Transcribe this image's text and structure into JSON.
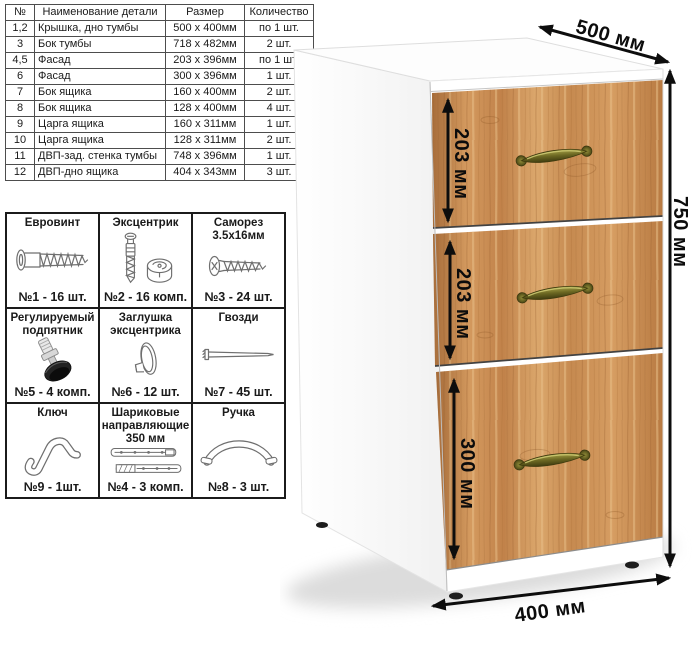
{
  "parts_table": {
    "headers": {
      "num": "№",
      "name": "Наименование детали",
      "size": "Размер",
      "qty": "Количество"
    },
    "rows": [
      {
        "num": "1,2",
        "name": "Крышка, дно тумбы",
        "size": "500 x 400мм",
        "qty": "по 1 шт."
      },
      {
        "num": "3",
        "name": "Бок тумбы",
        "size": "718 x 482мм",
        "qty": "2 шт."
      },
      {
        "num": "4,5",
        "name": "Фасад",
        "size": "203 x 396мм",
        "qty": "по 1 шт."
      },
      {
        "num": "6",
        "name": "Фасад",
        "size": "300 x 396мм",
        "qty": "1 шт."
      },
      {
        "num": "7",
        "name": "Бок ящика",
        "size": "160 x 400мм",
        "qty": "2 шт."
      },
      {
        "num": "8",
        "name": "Бок ящика",
        "size": "128 x 400мм",
        "qty": "4 шт."
      },
      {
        "num": "9",
        "name": "Царга ящика",
        "size": "160 x 311мм",
        "qty": "1 шт."
      },
      {
        "num": "10",
        "name": "Царга ящика",
        "size": "128 x 311мм",
        "qty": "2 шт."
      },
      {
        "num": "11",
        "name": "ДВП-зад. стенка тумбы",
        "size": "748 x 396мм",
        "qty": "1 шт."
      },
      {
        "num": "12",
        "name": "ДВП-дно ящика",
        "size": "404 x 343мм",
        "qty": "3 шт."
      }
    ]
  },
  "hardware": {
    "items": [
      {
        "title": "Евровинт",
        "qty": "№1 - 16 шт.",
        "icon": "euro-screw-icon"
      },
      {
        "title": "Эксцентрик",
        "qty": "№2 - 16 комп.",
        "icon": "cam-lock-icon"
      },
      {
        "title": "Саморез 3.5х16мм",
        "qty": "№3 - 24 шт.",
        "icon": "self-tapping-screw-icon"
      },
      {
        "title": "Регулируемый подпятник",
        "qty": "№5 - 4 комп.",
        "icon": "adjustable-foot-icon"
      },
      {
        "title": "Заглушка эксцентрика",
        "qty": "№6 - 12 шт.",
        "icon": "cam-cover-icon"
      },
      {
        "title": "Гвозди",
        "qty": "№7 - 45 шт.",
        "icon": "nail-icon"
      },
      {
        "title": "Ключ",
        "qty": "№9 - 1шт.",
        "icon": "cam-key-icon"
      },
      {
        "title": "Шариковые направляющие 350 мм",
        "qty": "№4 - 3 комп.",
        "icon": "ball-bearing-slides-icon"
      },
      {
        "title": "Ручка",
        "qty": "№8 - 3 шт.",
        "icon": "bow-handle-icon"
      }
    ]
  },
  "diagram": {
    "depth_label": "500 мм",
    "height_label": "750 мм",
    "width_label": "400 мм",
    "drawer_labels": [
      "203 мм",
      "203 мм",
      "300 мм"
    ],
    "colors": {
      "wood": "#c98f55",
      "wood_grain_dark": "#9a6130",
      "handle_brass": "#6f6b24",
      "dimension_arrow": "#0d0d0d",
      "cabinet_body": "#ffffff"
    }
  }
}
